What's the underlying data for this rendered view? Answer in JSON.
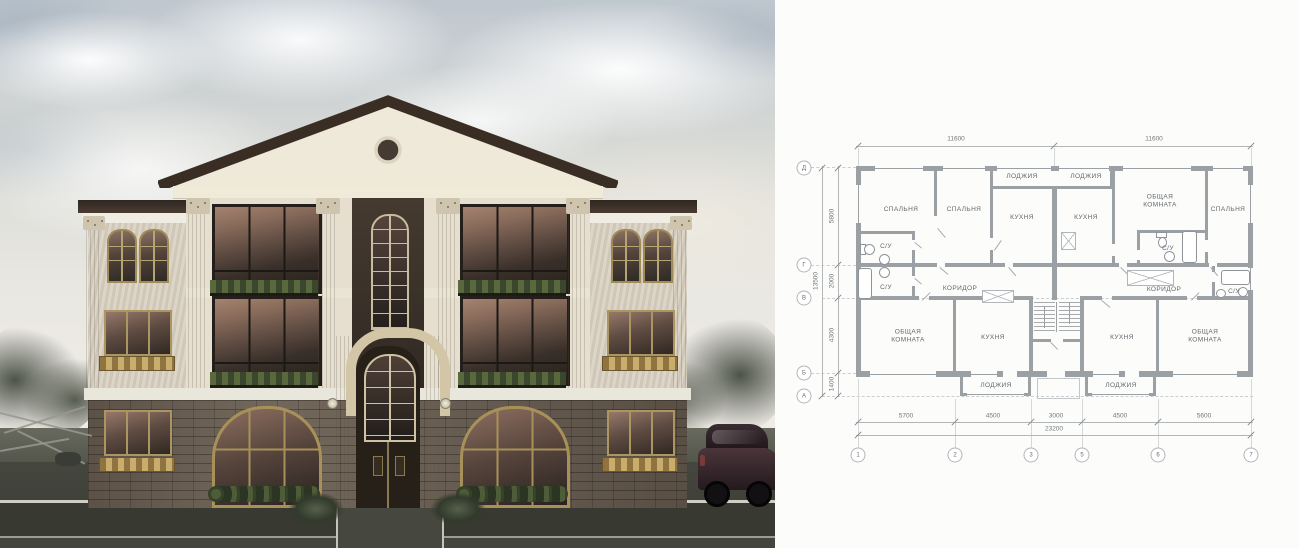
{
  "plan": {
    "rooms": [
      "СПАЛЬНЯ",
      "СПАЛЬНЯ",
      "ЛОДЖИЯ",
      "КУХНЯ",
      "ЛОДЖИЯ",
      "КУХНЯ",
      "ОБЩАЯ КОМНАТА",
      "СПАЛЬНЯ",
      "С/У",
      "С/У",
      "КОРИДОР",
      "С/У",
      "КОРИДОР",
      "С/У",
      "ОБЩАЯ КОМНАТА",
      "КУХНЯ",
      "КУХНЯ",
      "ОБЩАЯ КОМНАТА",
      "ЛОДЖИЯ",
      "ЛОДЖИЯ"
    ],
    "dims": {
      "top": [
        "11600",
        "11600"
      ],
      "bottom": [
        "5700",
        "4500",
        "3000",
        "4500",
        "5600"
      ],
      "bottom_total": "23200",
      "left": [
        "5800",
        "2000",
        "4300",
        "1400"
      ],
      "left_total": "13500"
    },
    "grid": {
      "columns": [
        "1",
        "2",
        "3",
        "5",
        "6",
        "7"
      ],
      "rows": [
        "Д",
        "Г",
        "В",
        "Б",
        "А"
      ]
    }
  },
  "colors": {
    "plan_wall": "#9aa0a4",
    "paper": "#fcfcfa",
    "roof_dark": "#3a2d24",
    "facade_cream": "#e6dfd0",
    "stucco": "#d8d1c3",
    "gold_frame": "#a89158",
    "glass_warm": "#8a6c5c",
    "stone": "#6f6458",
    "pavement": "#3a3b34"
  }
}
